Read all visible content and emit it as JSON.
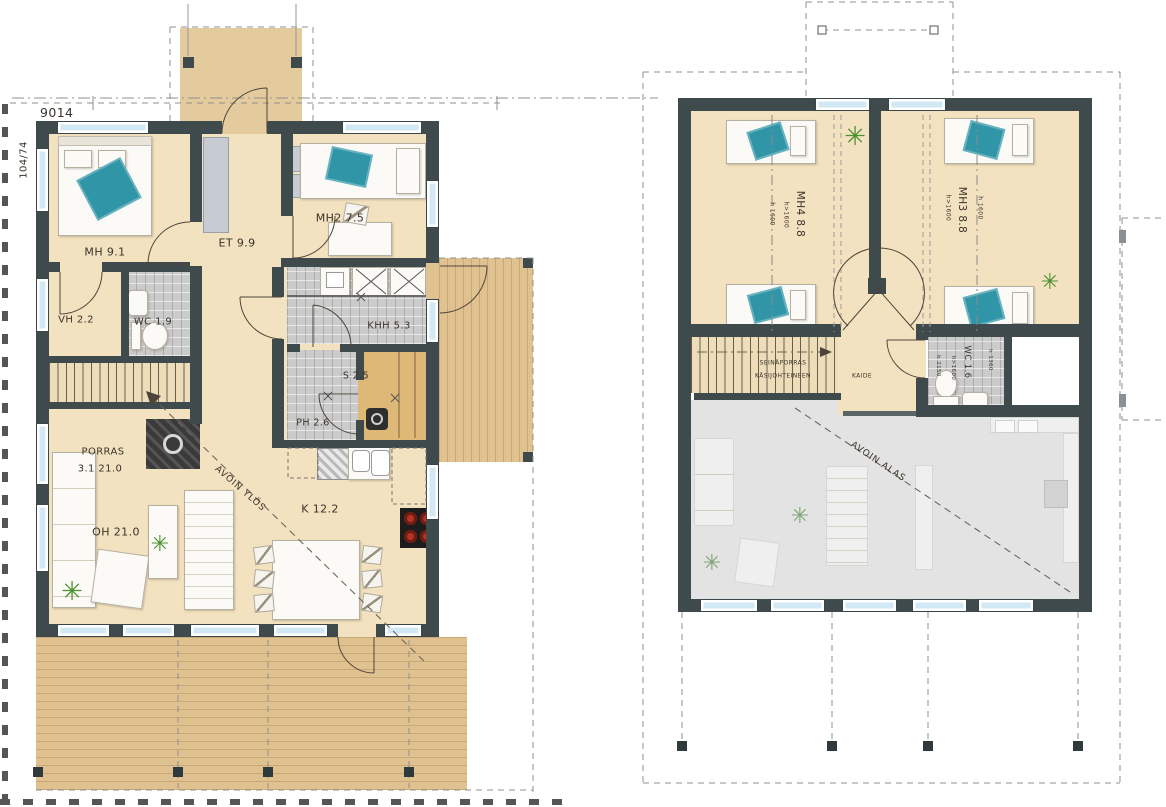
{
  "sheet": {
    "width_dimension": "9014",
    "scale_ref": "104/74"
  },
  "floor1": {
    "rooms": {
      "mh1": "MH 9.1",
      "et": "ET 9.9",
      "mh2": "MH2 7.5",
      "vh": "VH 2.2",
      "wc": "WC 1.9",
      "khh": "KHH 5.3",
      "s": "S 2.5",
      "ph": "PH 2.6",
      "porras": "PORRAS",
      "porras_area": "3.1 21.0",
      "oh": "OH 21.0",
      "k": "K 12.2"
    },
    "annotations": {
      "avoin_ylos": "AVOIN YLÖS"
    }
  },
  "floor2": {
    "rooms": {
      "mh4": "MH4 8.8",
      "mh3": "MH3 8.8",
      "wc": "WC 1.6"
    },
    "heights": {
      "over_1600": "h>1600",
      "eq_1600": "h 1600",
      "h_1360": "h 1360",
      "h_2150": "h 2150"
    },
    "annotations": {
      "stair_note_1": "SEINÄPORRAS",
      "stair_note_2": "KÄSIJOHTEINEEN",
      "kaide": "KAIDE",
      "avoin_alas": "AVOIN ALAS"
    }
  },
  "icons": {
    "plant": "✳"
  },
  "colors": {
    "wall": "#3f4a4c",
    "floor": "#f3e2c0",
    "deck_wood": "#e0c190",
    "window": "#d2e9f5",
    "tile": "#cbcbcb",
    "void": "#e3e3e3",
    "accent_teal": "#2f95a7"
  }
}
